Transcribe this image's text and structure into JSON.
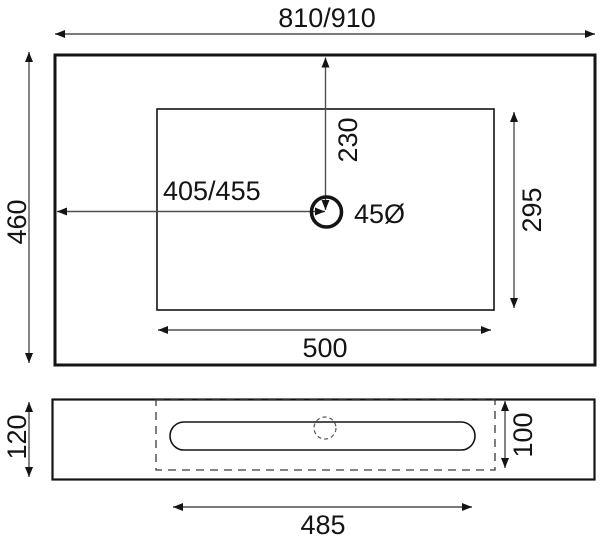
{
  "diagram": {
    "labels": {
      "overall_width": "810/910",
      "overall_depth": "460",
      "drain_from_left": "405/455",
      "drain_from_back": "230",
      "drain_diameter": "45Ø",
      "basin_cutout_width": "500",
      "basin_cutout_depth": "295",
      "front_height": "120",
      "bowl_depth": "100",
      "bowl_width": "485"
    },
    "colors": {
      "outline": "#141414",
      "dimension_line": "#4f4f4f",
      "background": "#ffffff"
    }
  }
}
